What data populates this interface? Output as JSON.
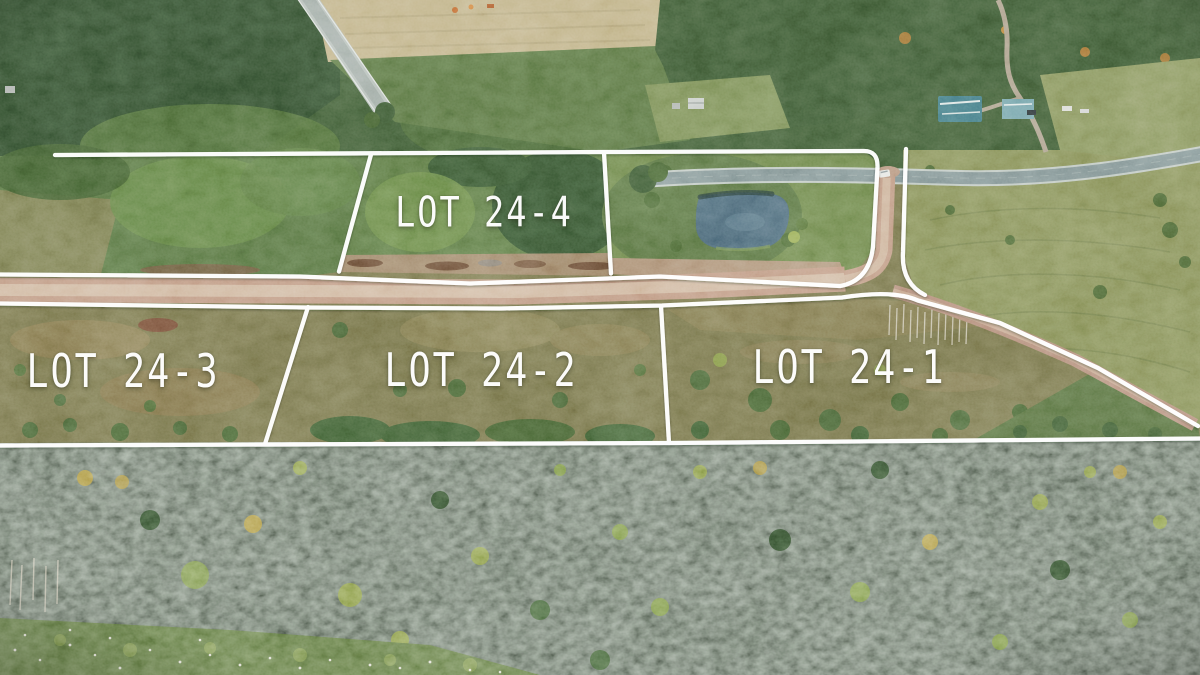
{
  "image": {
    "kind": "aerial-drone-photo",
    "description": "Drone aerial photograph of a rural subdivision: four cleared lots beside a new dirt road, a pond parcel, surrounding forest, and a highway, with white surveyed lot-boundary lines drawn over the photo."
  },
  "overlay": {
    "line_color": "#ffffff",
    "label_color": "#ffffff",
    "labels": [
      {
        "id": "lot-24-4",
        "text": "LOT 24-4"
      },
      {
        "id": "lot-24-3",
        "text": "LOT 24-3"
      },
      {
        "id": "lot-24-2",
        "text": "LOT 24-2"
      },
      {
        "id": "lot-24-1",
        "text": "LOT 24-1"
      }
    ]
  },
  "scene": {
    "colors": {
      "lot_ground": "#7c784a",
      "forest_top": "#3c5a31",
      "forest_bottom": "#2d4b28",
      "tan_field": "#c8b88c",
      "field_green": "#8d9659",
      "highway_asphalt": "#87999a",
      "dirt_road": "#c79e87",
      "dirt_road_center": "#dcc2ab",
      "gravel_road": "#bd9480",
      "pond": "#4c6b7e",
      "house_teal": "#3f7d8a",
      "car_white": "#f2f3f0"
    }
  }
}
